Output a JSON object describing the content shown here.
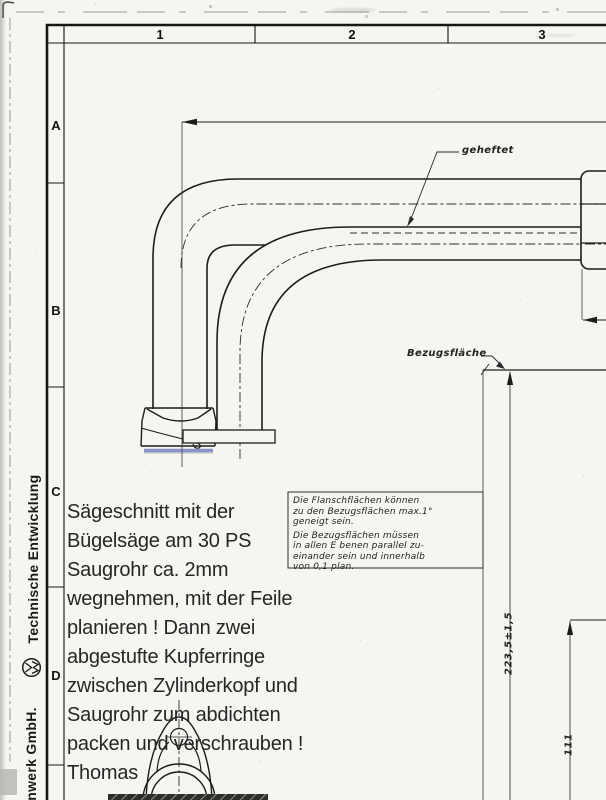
{
  "frame": {
    "columns": [
      "1",
      "2",
      "3"
    ],
    "rows": [
      "A",
      "B",
      "C",
      "D"
    ]
  },
  "sidebar": {
    "department": "Technische Entwicklung",
    "company": "enwerk GmbH.",
    "logo": "vw-roundel"
  },
  "annotations": {
    "weld_note": "geheftet",
    "datum_label": "Bezugsfläche"
  },
  "dimensions": {
    "overall_length": "223,5±1,5",
    "height": "111"
  },
  "note_box": {
    "lines": [
      "Die Flanschflächen können",
      "zu den Bezugsflächen  max.1°",
      "geneigt  sein.",
      "Die Bezugsflächen  müssen",
      "in allen E benen  parallel   zu-",
      "einander  sein  und  innerhalb",
      "von  0,1  plan."
    ]
  },
  "handwritten_note": {
    "lines": [
      "Sägeschnitt mit der",
      "Bügelsäge am 30 PS",
      "Saugrohr ca. 2mm",
      "wegnehmen, mit der Feile",
      "planieren ! Dann zwei",
      "abgestufte Kupferringe",
      "zwischen Zylinderkopf und",
      "Saugrohr zum abdichten",
      "packen und verschrauben !",
      "Thomas"
    ]
  },
  "colors": {
    "highlight_blue": "#8b93cb",
    "ink": "#1f1f1f",
    "paper": "#f6f5f1"
  }
}
